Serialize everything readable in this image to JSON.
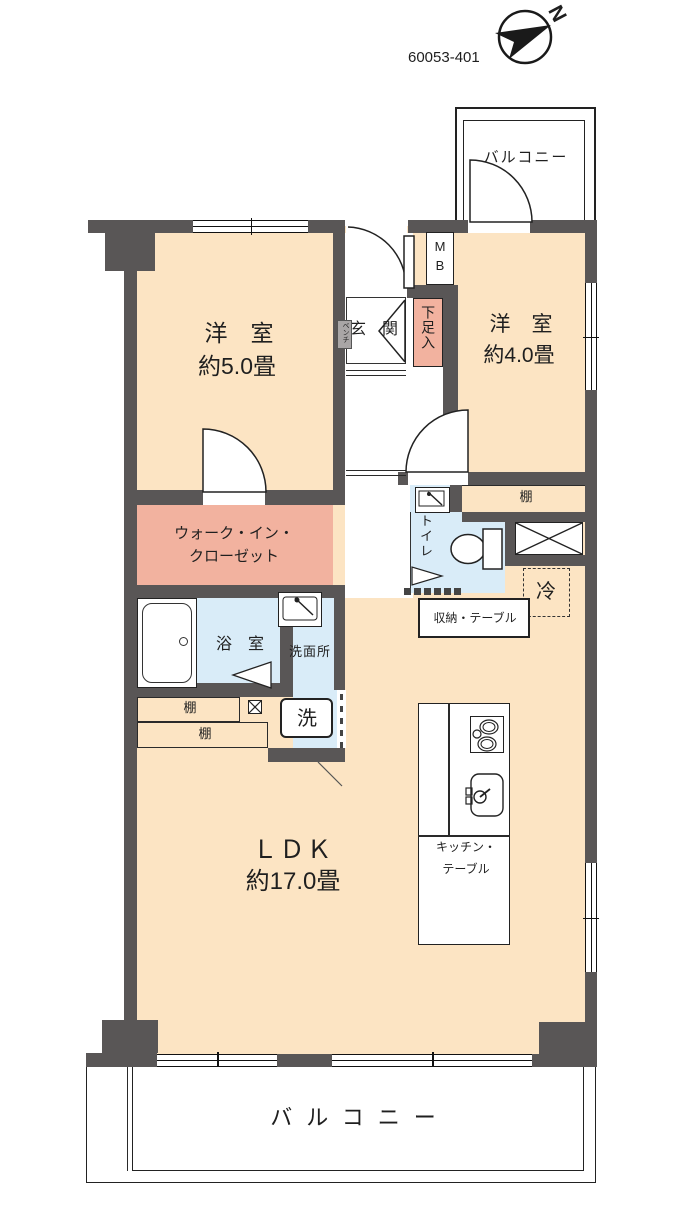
{
  "header": {
    "plan_id": "60053-401",
    "compass": "N"
  },
  "colors": {
    "wall": "#595656",
    "room": "#fce4c3",
    "closet": "#f2b29f",
    "wet": "#d9ecf8"
  },
  "rooms": {
    "bedroom5": {
      "name": "洋　室",
      "size": "約5.0畳"
    },
    "bedroom4": {
      "name": "洋　室",
      "size": "約4.0畳"
    },
    "ldk": {
      "name": "ＬＤＫ",
      "size": "約17.0畳"
    },
    "wic": {
      "line1": "ウォーク・イン・",
      "line2": "クローゼット"
    },
    "bath": {
      "name": "浴　室"
    },
    "washroom": {
      "name": "洗面所",
      "washer": "洗"
    },
    "toilet": {
      "name": "トイレ"
    },
    "entrance": {
      "name": "玄　関",
      "bench": "ベンチ",
      "shoe_storage": "下足入",
      "mb_line1": "M",
      "mb_line2": "B"
    },
    "balcony_top": {
      "name": "バルコニー"
    },
    "balcony_bottom": {
      "name": "バルコニー"
    }
  },
  "fixtures": {
    "shelf": "棚",
    "fridge": "冷",
    "storage_table": "収納・テーブル",
    "kitchen_table_line1": "キッチン・",
    "kitchen_table_line2": "テーブル"
  }
}
